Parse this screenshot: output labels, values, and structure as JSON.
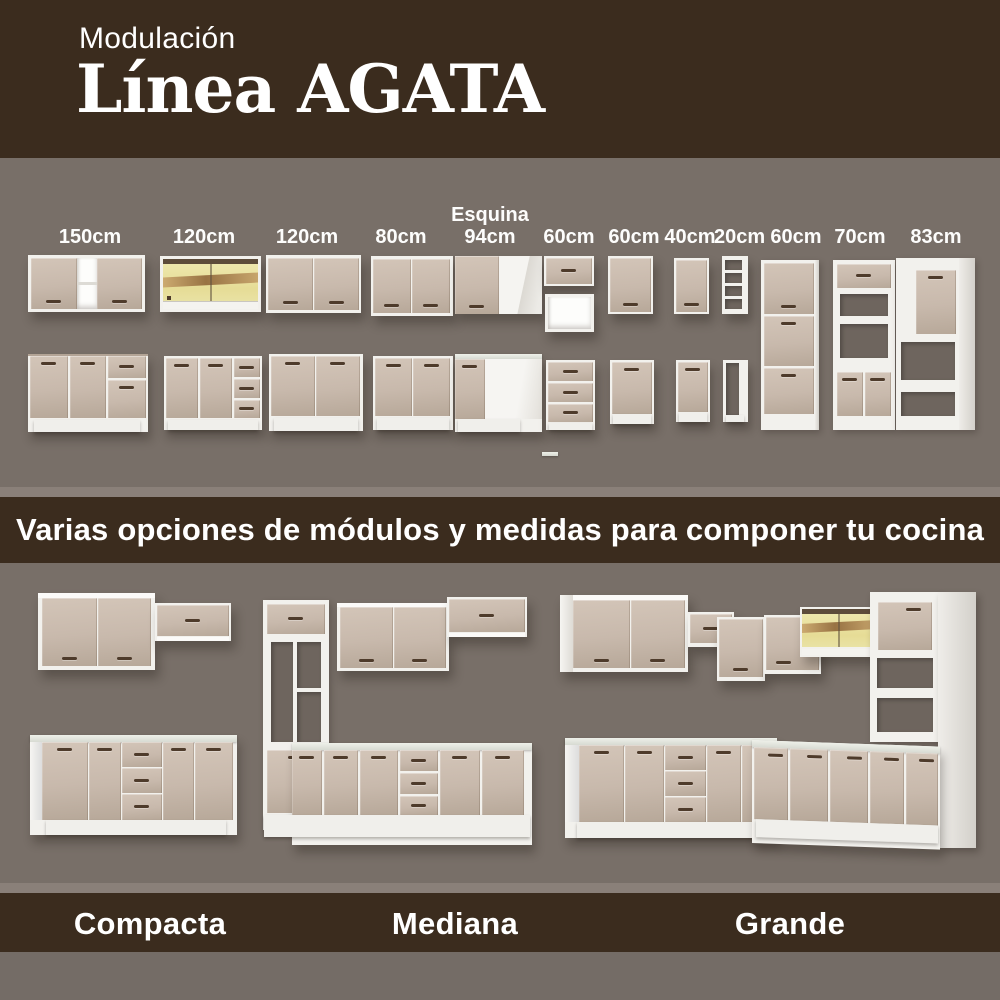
{
  "header": {
    "kicker": "Modulación",
    "title": "Línea AGATA"
  },
  "banner": {
    "text": "Varias opciones de módulos y medidas para componer tu cocina"
  },
  "modules": {
    "labels": [
      {
        "size": "150cm"
      },
      {
        "size": "120cm"
      },
      {
        "size": "120cm"
      },
      {
        "size": "80cm"
      },
      {
        "prefix": "Esquina",
        "size": "94cm"
      },
      {
        "size": "60cm"
      },
      {
        "size": "60cm"
      },
      {
        "size": "40cm"
      },
      {
        "size": "20cm"
      },
      {
        "size": "60cm"
      },
      {
        "size": "70cm"
      },
      {
        "size": "83cm"
      }
    ]
  },
  "configurations": [
    {
      "label": "Compacta"
    },
    {
      "label": "Mediana"
    },
    {
      "label": "Grande"
    }
  ],
  "colors": {
    "brand_brown": "#3B2C1E",
    "background_gray": "#786F68",
    "cabinet_beige": "#C8B9AC",
    "cabinet_white": "#F2F1ED",
    "glass_yellow": "#E9E2A4",
    "countertop_white": "#E3E6DD",
    "handle_brown": "#4E3B2B",
    "text_white": "#FFFFFF"
  }
}
